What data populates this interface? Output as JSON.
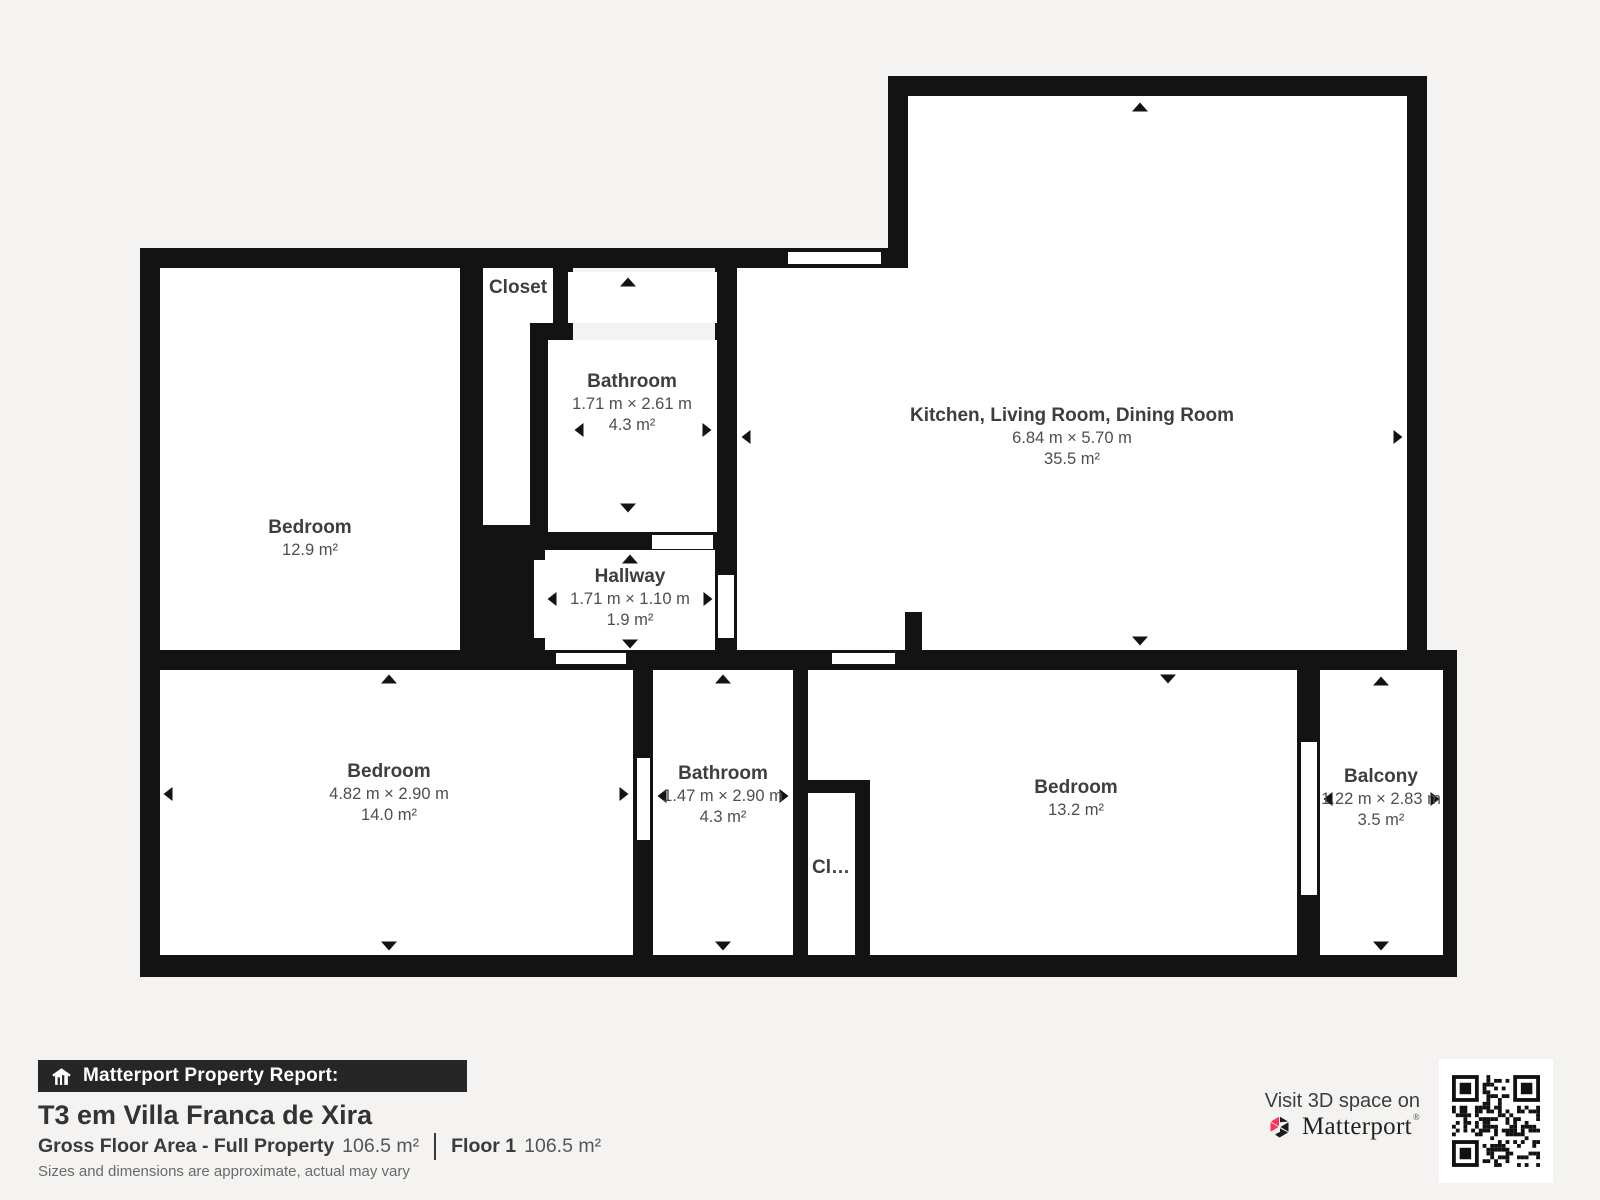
{
  "plan": {
    "wall_color": "#131313",
    "rooms": [
      {
        "key": "bedroom-top-left",
        "name": "Bedroom",
        "area": "12.9 m²"
      },
      {
        "key": "closet-top",
        "name": "Closet"
      },
      {
        "key": "bathroom-top",
        "name": "Bathroom",
        "dims": "1.71 m × 2.61 m",
        "area": "4.3 m²"
      },
      {
        "key": "hallway",
        "name": "Hallway",
        "dims": "1.71 m × 1.10 m",
        "area": "1.9 m²"
      },
      {
        "key": "kitchen-living-dining",
        "name": "Kitchen, Living Room, Dining Room",
        "dims": "6.84 m × 5.70 m",
        "area": "35.5 m²"
      },
      {
        "key": "bedroom-bottom-left",
        "name": "Bedroom",
        "dims": "4.82 m × 2.90 m",
        "area": "14.0 m²"
      },
      {
        "key": "bathroom-bottom",
        "name": "Bathroom",
        "dims": "1.47 m × 2.90 m",
        "area": "4.3 m²"
      },
      {
        "key": "closet-bottom",
        "name": "Cl…"
      },
      {
        "key": "bedroom-bottom-right",
        "name": "Bedroom",
        "area": "13.2 m²"
      },
      {
        "key": "balcony",
        "name": "Balcony",
        "dims": "1.22 m × 2.83 m",
        "area": "3.5 m²"
      }
    ]
  },
  "footer": {
    "report_bar_label": "Matterport Property Report:",
    "property_title": "T3 em Villa Franca de Xira",
    "gross_floor_label": "Gross Floor Area - Full Property",
    "gross_floor_value": "106.5 m²",
    "floor_label": "Floor 1",
    "floor_value": "106.5 m²",
    "disclaimer": "Sizes and dimensions are approximate, actual may vary",
    "visit_text": "Visit 3D space on",
    "brand_name": "Matterport",
    "brand_accent_color": "#ff3158"
  }
}
